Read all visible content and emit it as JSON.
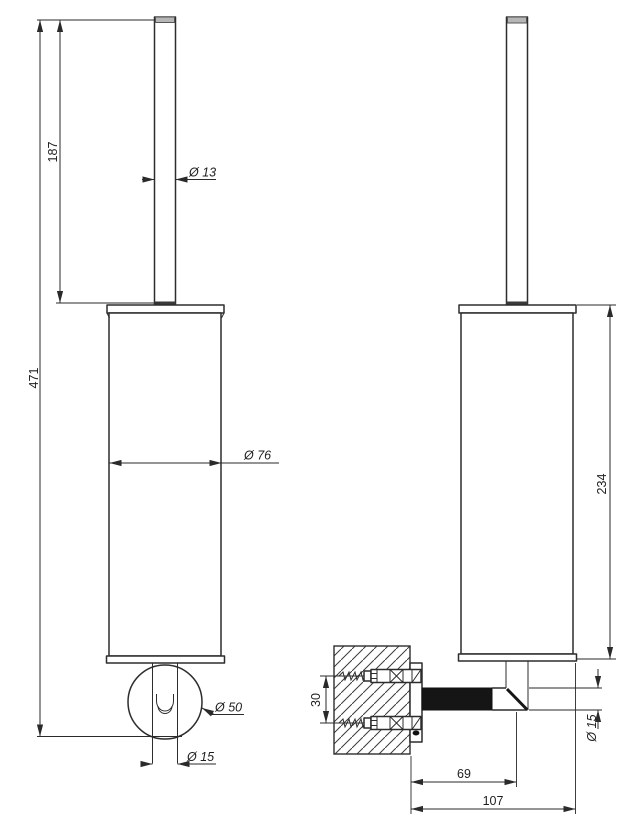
{
  "canvas": {
    "width": 634,
    "height": 827,
    "background": "#ffffff"
  },
  "style": {
    "line_color": "#2d2d2d",
    "dimension_color": "#2a2a2a",
    "text_color": "#1f1f1f",
    "arm_fill": "#151515",
    "handle_cap_fill": "#b6b6b6"
  },
  "dimensions": {
    "front": {
      "handle_length": "187",
      "total_height": "471",
      "handle_diameter": "Ø 13",
      "body_diameter": "Ø 76",
      "rosette_diameter": "Ø 50",
      "stem_diameter": "Ø 15"
    },
    "side": {
      "holder_height": "234",
      "screw_spacing": "30",
      "arm_diameter": "Ø 15",
      "wall_to_stem_center": "69",
      "wall_to_front_edge": "107"
    }
  }
}
